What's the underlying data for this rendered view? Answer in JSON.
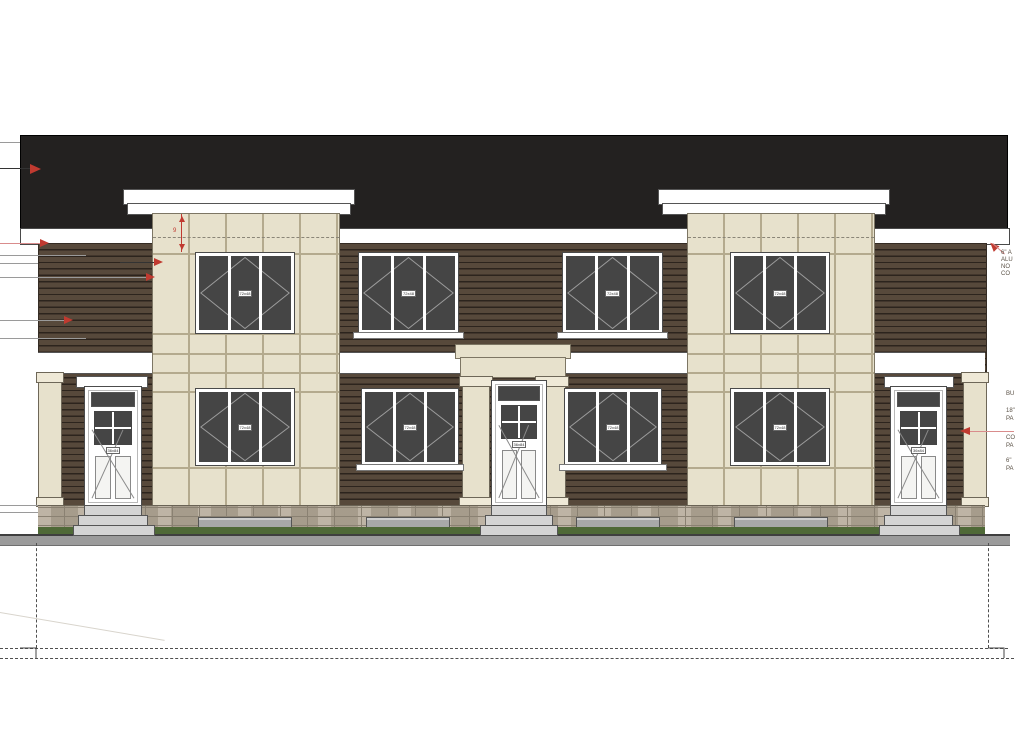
{
  "colors": {
    "roof": "#232120",
    "siding": "#57493b",
    "sidingline": "#2c241d",
    "panel": "#e7e1cc",
    "panelline": "#b4aa8e",
    "glass": "#454545",
    "trim": "#ffffff",
    "stone": "#b3a896",
    "stoneline": "#8a8172",
    "grass": "#4f6937",
    "grade": "#9b9b9b",
    "step": "#d4d4d4",
    "red": "#c03a30",
    "leader": "#d98c8c",
    "anno": "#5a5146"
  },
  "labels": {
    "window_size": "72x48",
    "door_size": "36x84"
  },
  "annotations": {
    "dimension_label": "9",
    "right_top": {
      "lines": [
        "6\" A",
        "ALU",
        "NO",
        "CO"
      ]
    },
    "right_mid": {
      "lines": [
        "BU",
        "18\"",
        "PA",
        "CO",
        "PA",
        "6\"",
        "PA"
      ]
    }
  }
}
